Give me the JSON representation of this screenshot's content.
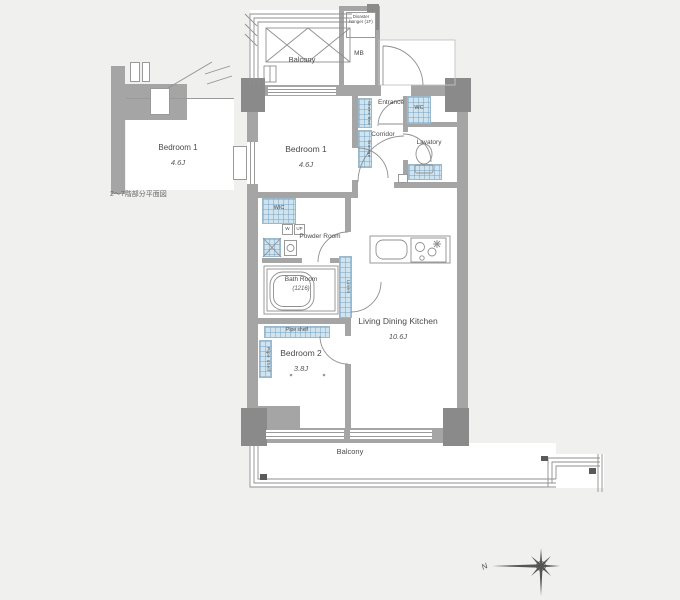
{
  "inset": {
    "room": "Bedroom 1",
    "size": "4.6J",
    "caption": "2〜7階部分平面図"
  },
  "rooms": {
    "balcony_top": {
      "label": "Balcony"
    },
    "entrance": {
      "label": "Entrance"
    },
    "corridor": {
      "label": "Corridor"
    },
    "lavatory": {
      "label": "Lavatory"
    },
    "bedroom1": {
      "label": "Bedroom 1",
      "size": "4.6J"
    },
    "powder": {
      "label": "Powder Room"
    },
    "bath": {
      "label": "Bath Room",
      "size": "(1216)"
    },
    "bedroom2": {
      "label": "Bedroom 2",
      "size": "3.8J"
    },
    "ldk": {
      "label": "Living Dining Kitchen",
      "size": "10.6J"
    },
    "balcony_bottom": {
      "label": "Balcony"
    }
  },
  "fixtures": {
    "mb": "MB",
    "wc": "WC",
    "wic": "WIC",
    "shoes_box": "Shoes Box",
    "storage": "Storage",
    "washer": "W",
    "up": "UP",
    "linen": "Linen",
    "pipe_shelf_top": "Pipe shelf",
    "pipe_shelf_side": "Pipe shelf",
    "disaster": "Disaster hanger (1F)"
  },
  "compass": {
    "north": "N"
  },
  "colors": {
    "bg": "#f0f1ee",
    "wall": "#a5a5a5",
    "pillar": "#8a8a8a",
    "tile": "#cfe4ef"
  }
}
